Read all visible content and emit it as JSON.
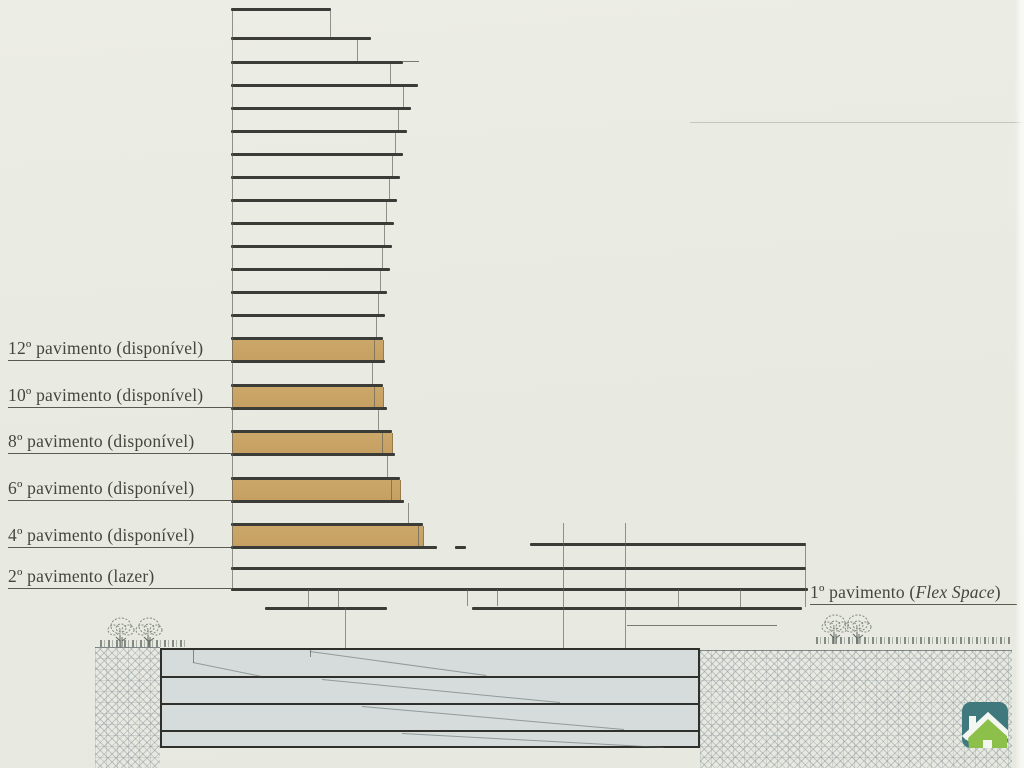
{
  "canvas": {
    "width": 1024,
    "height": 768,
    "paper_color": "#e9ebe3",
    "ink_color": "#3b3b38",
    "thin_color": "#5c605a",
    "tan_color": "#c7a365"
  },
  "labels": {
    "left": [
      {
        "text": "12º pavimento (disponível)",
        "x": 8,
        "underline_end": 231,
        "underline_y": 361
      },
      {
        "text": "10º pavimento (disponível)",
        "x": 8,
        "underline_end": 231,
        "underline_y": 408
      },
      {
        "text": "8º pavimento (disponível)",
        "x": 8,
        "underline_end": 231,
        "underline_y": 454
      },
      {
        "text": "6º pavimento (disponível)",
        "x": 8,
        "underline_end": 231,
        "underline_y": 501
      },
      {
        "text": "4º pavimento (disponível)",
        "x": 8,
        "underline_end": 231,
        "underline_y": 548
      },
      {
        "text": "2º pavimento (lazer)",
        "x": 8,
        "underline_end": 231,
        "underline_y": 589
      }
    ],
    "right": {
      "prefix": "1º pavimento (",
      "italic": "Flex Space",
      "suffix": ")",
      "x": 810,
      "underline_end": 1017,
      "underline_y": 605
    }
  },
  "building": {
    "slabs": [
      [
        231,
        331,
        8
      ],
      [
        231,
        371,
        37
      ],
      [
        231,
        403,
        61
      ],
      [
        231,
        418,
        84
      ],
      [
        231,
        411,
        107
      ],
      [
        231,
        407,
        130
      ],
      [
        231,
        403,
        153
      ],
      [
        231,
        400,
        176
      ],
      [
        231,
        397,
        199
      ],
      [
        231,
        394,
        222
      ],
      [
        231,
        392,
        245
      ],
      [
        231,
        390,
        268
      ],
      [
        231,
        387,
        291
      ],
      [
        231,
        385,
        314
      ],
      [
        231,
        383,
        337
      ],
      [
        231,
        385,
        360
      ],
      [
        231,
        383,
        384
      ],
      [
        231,
        387,
        407
      ],
      [
        231,
        392,
        430
      ],
      [
        231,
        395,
        453
      ],
      [
        231,
        400,
        477
      ],
      [
        231,
        404,
        500
      ],
      [
        231,
        423,
        523
      ],
      [
        231,
        437,
        546
      ],
      [
        455,
        466,
        546
      ],
      [
        530,
        806,
        543
      ],
      [
        231,
        806,
        567
      ],
      [
        231,
        808,
        588
      ],
      [
        265,
        387,
        607
      ],
      [
        472,
        802,
        607
      ]
    ],
    "thin_lines": [
      [
        403,
        419,
        61
      ],
      [
        627,
        777,
        625
      ]
    ],
    "tan_floors": [
      [
        232,
        340,
        151,
        20
      ],
      [
        232,
        387,
        151,
        20
      ],
      [
        232,
        433,
        160,
        20
      ],
      [
        232,
        480,
        168,
        20
      ],
      [
        232,
        526,
        191,
        20
      ]
    ],
    "verticals": [
      [
        232,
        11,
        588
      ],
      [
        330,
        11,
        37
      ],
      [
        357,
        40,
        61
      ],
      [
        390,
        64,
        84
      ],
      [
        403,
        87,
        107
      ],
      [
        398,
        110,
        130
      ],
      [
        395,
        133,
        153
      ],
      [
        392,
        156,
        176
      ],
      [
        389,
        179,
        199
      ],
      [
        386,
        202,
        222
      ],
      [
        384,
        225,
        245
      ],
      [
        382,
        248,
        268
      ],
      [
        380,
        271,
        291
      ],
      [
        378,
        294,
        314
      ],
      [
        376,
        317,
        337
      ],
      [
        374,
        340,
        360
      ],
      [
        372,
        363,
        384
      ],
      [
        374,
        387,
        407
      ],
      [
        378,
        410,
        430
      ],
      [
        382,
        433,
        453
      ],
      [
        387,
        456,
        477
      ],
      [
        391,
        480,
        500
      ],
      [
        408,
        503,
        523
      ],
      [
        418,
        526,
        546
      ],
      [
        563,
        523,
        648
      ],
      [
        625,
        523,
        650
      ],
      [
        345,
        607,
        648
      ],
      [
        805,
        543,
        607
      ],
      [
        308,
        589,
        607
      ],
      [
        338,
        589,
        607
      ],
      [
        467,
        589,
        606
      ],
      [
        497,
        589,
        606
      ],
      [
        678,
        589,
        607
      ],
      [
        740,
        589,
        607
      ]
    ]
  },
  "basement": {
    "outer": [
      160,
      648,
      540,
      100
    ],
    "dividers": [
      676,
      703,
      730
    ],
    "diagonals": [
      [
        193,
        662,
        262,
        676
      ],
      [
        310,
        651,
        486,
        675
      ],
      [
        322,
        679,
        560,
        702
      ],
      [
        362,
        706,
        624,
        729
      ],
      [
        402,
        733,
        664,
        747
      ]
    ],
    "ticks": [
      [
        193,
        650,
        663
      ],
      [
        310,
        650,
        657
      ]
    ]
  },
  "ground": {
    "hatch_left": [
      95,
      647,
      65,
      121
    ],
    "hatch_right": [
      700,
      650,
      312,
      118
    ],
    "grass_left": [
      100,
      640,
      88
    ],
    "grass_right": [
      816,
      637,
      196
    ]
  },
  "trees": [
    {
      "cx": 121,
      "base": 647
    },
    {
      "cx": 149,
      "base": 647
    },
    {
      "cx": 835,
      "base": 644
    },
    {
      "cx": 858,
      "base": 644
    }
  ],
  "artifacts": {
    "scan_line": [
      690,
      122,
      334
    ]
  },
  "logo": {
    "x": 962,
    "y": 702,
    "size": 46,
    "bg_color": "#40797d",
    "house_color": "#8dc04b",
    "white_color": "#f4f6f1"
  }
}
